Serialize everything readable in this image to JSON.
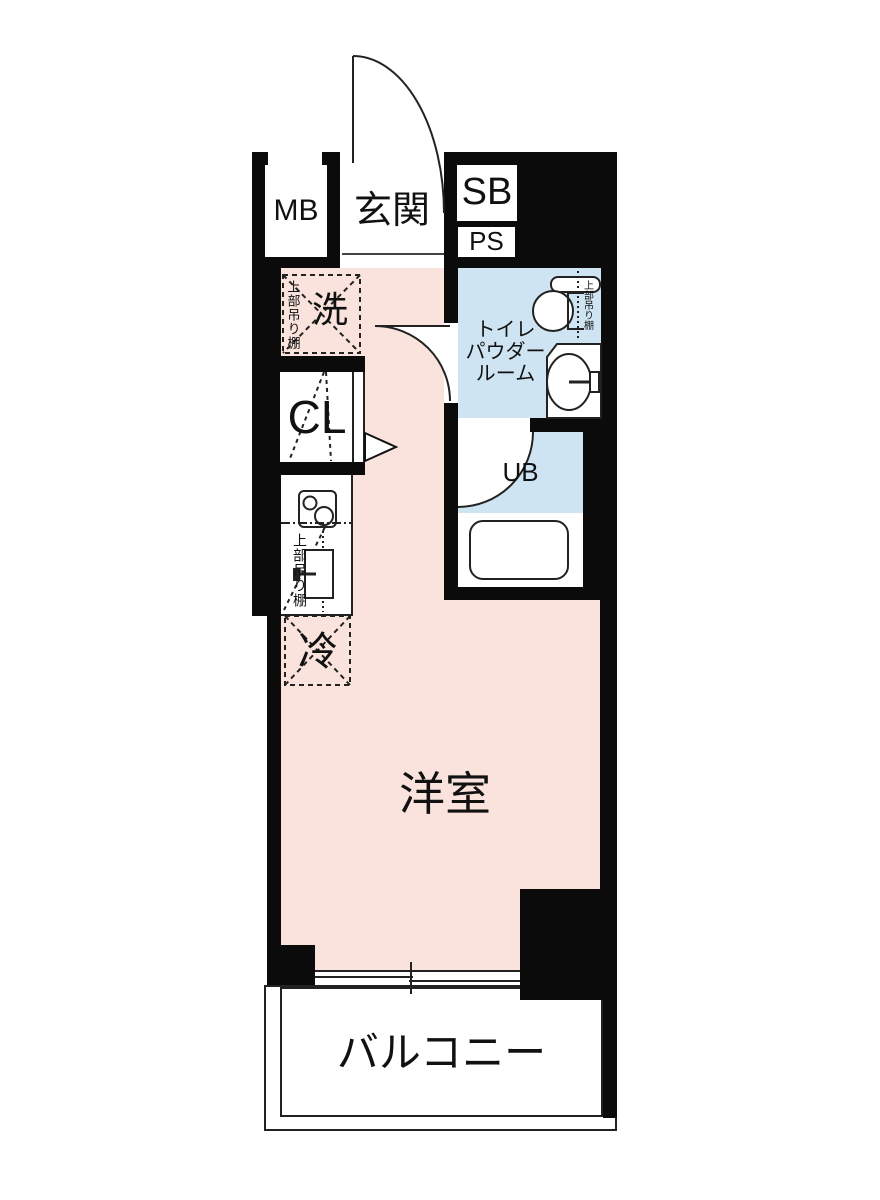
{
  "colors": {
    "wall": "#0b0b0b",
    "room_pink": "#f9e3dc",
    "wet_blue": "#cfe4f2",
    "line": "#222222",
    "text": "#111111"
  },
  "rooms": {
    "meter_box": "MB",
    "entrance": "玄関",
    "shoe_box": "SB",
    "pipe_space": "PS",
    "washing_machine": "洗",
    "closet": "CL",
    "refrigerator": "冷",
    "unit_bath": "UB",
    "western_room": "洋室",
    "balcony": "バルコニー",
    "powder_room_line1": "トイレ",
    "powder_room_line2": "パウダー",
    "powder_room_line3": "ルーム",
    "upper_shelf_washer": "上部吊り棚",
    "upper_shelf_kitchen": "上部吊り棚",
    "upper_shelf_toilet": "上部吊り棚"
  }
}
